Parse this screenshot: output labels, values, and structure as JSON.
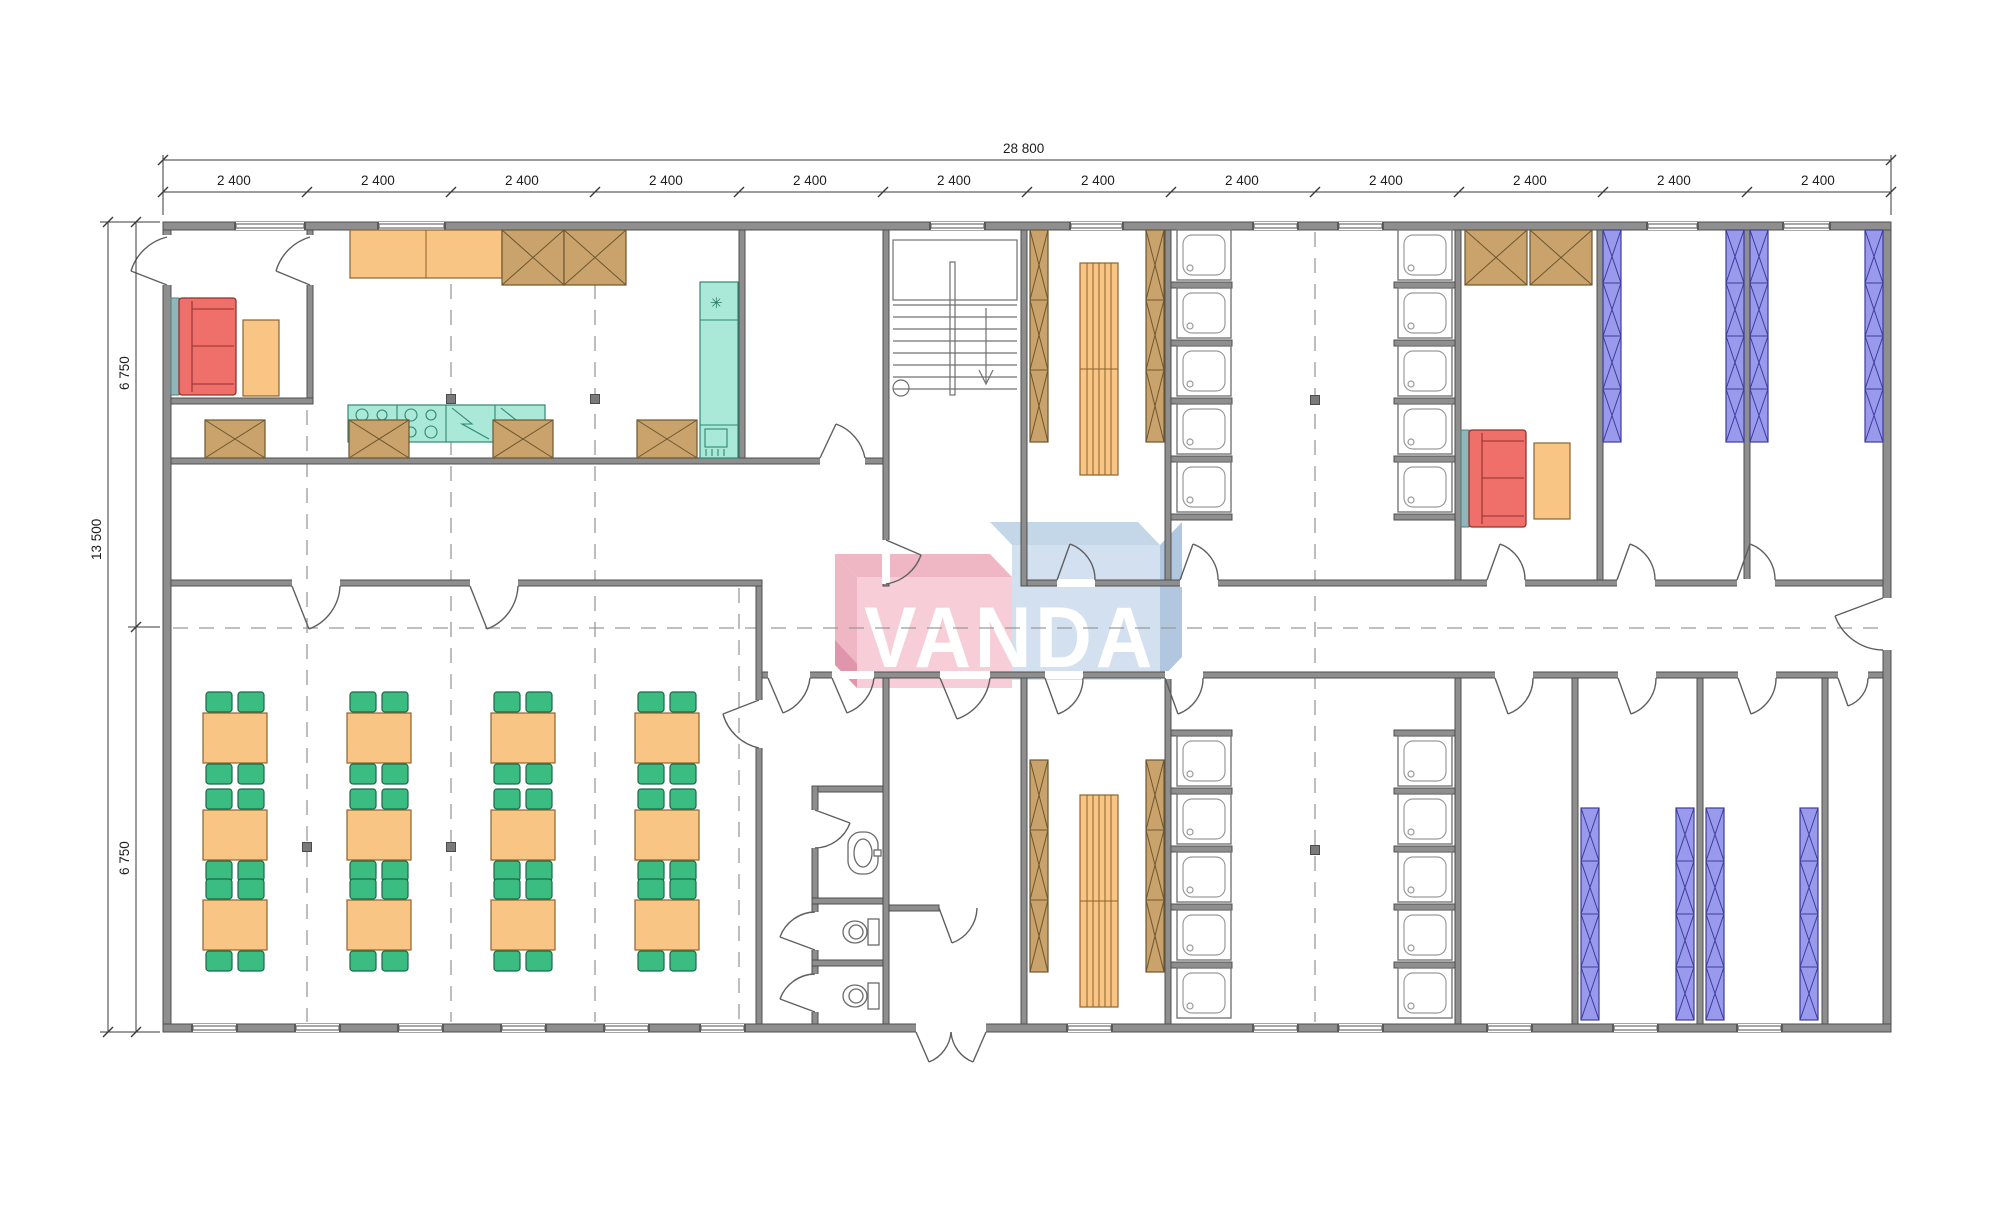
{
  "drawing": {
    "type": "floor-plan",
    "description": "Modular building floor plan with kitchen, dining hall, staircase, dorm rooms, showers and WCs"
  },
  "logo": {
    "text": "VANDA"
  },
  "dimensions": {
    "top_total": "28 800",
    "top_modules": [
      "2 400",
      "2 400",
      "2 400",
      "2 400",
      "2 400",
      "2 400",
      "2 400",
      "2 400",
      "2 400",
      "2 400",
      "2 400",
      "2 400"
    ],
    "left_total": "13 500",
    "left_upper": "6 750",
    "left_lower": "6 750"
  },
  "symbols": {
    "freezer_icon": "✳"
  },
  "colors": {
    "wall": "#8e8e8e",
    "wallStroke": "#4f4f4f",
    "dash": "#9a9a9a",
    "sofa": "#ef6f6a",
    "sofaStroke": "#93312d",
    "table": "#f9c584",
    "tableStroke": "#8a6430",
    "chair": "#3bbc80",
    "chairStroke": "#17694a",
    "kitchen": "#aae8d8",
    "kitchenStroke": "#2f8873",
    "teal": "#8fb6b8",
    "tealStroke": "#4f7d80",
    "wardrobe": "#c9a36b",
    "wardrobeStroke": "#6d5730",
    "bunkBlue": "#9a9aec",
    "bunkBlueStroke": "#3c3c9e",
    "stallStroke": "#777777",
    "logoPink": "#f7c9d4",
    "logoPinkDark": "#eeb0c0",
    "logoPinkDarker": "#dd8da4",
    "logoBlue": "#cfdeef",
    "logoBlueDark": "#c0d4e8",
    "logoBlueDarker": "#aac3dd"
  }
}
